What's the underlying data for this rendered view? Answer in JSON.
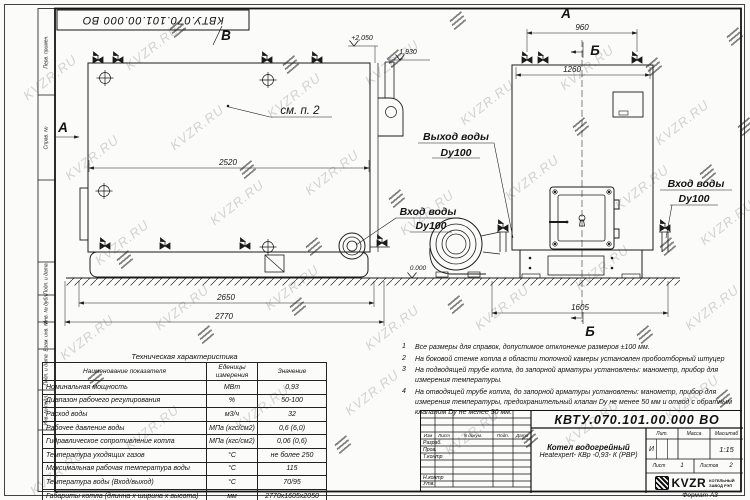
{
  "watermark": {
    "text": "KVZR.RU"
  },
  "frame": {
    "top_stamp": "КВТУ.070.101.00.000  ВО",
    "side_labels": [
      "Перв. примен.",
      "Справ. №",
      "Подп. и дата",
      "Инв. № дубл.",
      "Взам. инв. №",
      "Подп. и дата",
      "Инв. № подл."
    ]
  },
  "views": {
    "label_a": "А",
    "label_b": "Б",
    "label_v": "В",
    "see_note": "см. п. 2"
  },
  "ports": {
    "outlet": {
      "l1": "Выход воды",
      "l2": "Dy100"
    },
    "inlet_left": {
      "l1": "Вход воды",
      "l2": "Dy100"
    },
    "inlet_right": {
      "l1": "Вход воды",
      "l2": "Dy100"
    }
  },
  "dims": {
    "d2520": "2520",
    "d2650": "2650",
    "d2770": "2770",
    "d960": "960",
    "d1260": "1260",
    "d1605": "1605",
    "lvl_top": "+2,050",
    "lvl_mid": "1,930",
    "lvl_zero": "0.000"
  },
  "tech_table": {
    "title": "Техническая характеристика",
    "headers": [
      "Наименование показателя",
      "Еденицы измерения",
      "Значение"
    ],
    "rows": [
      [
        "Номинальная мощность",
        "МВт",
        "0,93"
      ],
      [
        "Диапазон рабочего регулирования",
        "%",
        "50-100"
      ],
      [
        "Расход воды",
        "м3/ч",
        "32"
      ],
      [
        "Рабочее давление воды",
        "МПа (кгс/см2)",
        "0,6 (6,0)"
      ],
      [
        "Гидравлическое сопротивление котла",
        "МПа (кгс/см2)",
        "0,06 (0,6)"
      ],
      [
        "Температура уходящих газов",
        "°С",
        "не более 250"
      ],
      [
        "Максимальная рабочая температура воды",
        "°С",
        "115"
      ],
      [
        "Температура воды (Вход/выход)",
        "°С",
        "70/95"
      ],
      [
        "Габариты котла (длинна х ширина х высота)",
        "мм",
        "2770х1605х2050"
      ]
    ]
  },
  "notes": {
    "items": [
      {
        "num": "1",
        "text": "Все размеры для справок, допустимое отклонение размеров ±100 мм."
      },
      {
        "num": "2",
        "text": "На боковой стенке котла в области топочной камеры установлен пробоотборный штуцер"
      },
      {
        "num": "3",
        "text": "На  подводящей трубе котла, до запорной арматуры установлены: манометр, прибор для измерения температуры."
      },
      {
        "num": "4",
        "text": "На отводящей трубе котла, до запорной арматуры установлены: манометр, прибор для измерения температуры, предохранительный клапан Dу не менее 50 мм и отвод с обратным клапаном Dу не менее 50 мм."
      }
    ]
  },
  "title_block": {
    "doc_number": "КВТУ.070.101.00.000  ВО",
    "product_line1": "Котел водогрейный",
    "product_line2": "Heatexpert- КВр -0,93- К (РВР)",
    "header_cells": [
      "Изм",
      "Лист",
      "N докум.",
      "Подп.",
      "Дата"
    ],
    "rows": [
      "Разраб.",
      "Пров.",
      "Т.контр",
      "Н.контр",
      "Утв."
    ],
    "lit_label": "Лит.",
    "lit_value": "И",
    "mass_label": "Масса",
    "scale_label": "Масштаб",
    "scale_value": "1:15",
    "sheet_label": "Лист",
    "sheet_value": "1",
    "sheets_label": "Листов",
    "sheets_value": "2",
    "logo_text": "KVZR",
    "logo_sub1": "КОТЕЛЬНЫЙ",
    "logo_sub2": "ЗАВОД РЭП",
    "format_label": "Формат  А3"
  }
}
